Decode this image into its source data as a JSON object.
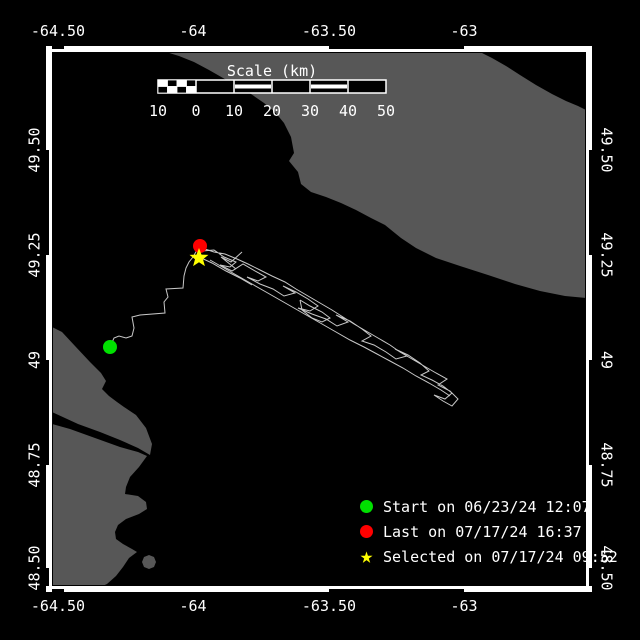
{
  "map": {
    "size": {
      "w": 640,
      "h": 640
    },
    "colors": {
      "water": "#000000",
      "land": "#575757",
      "track": "#c8c8c8",
      "frame": "#ffffff",
      "text": "#ffffff",
      "start": "#00e000",
      "last": "#ff0000",
      "selected": "#ffff00"
    },
    "frame": {
      "inner": {
        "x": 52,
        "y": 52,
        "w": 534,
        "h": 534
      },
      "band_width": 6,
      "black_segments_h": [
        [
          52,
          64
        ],
        [
          329,
          464
        ]
      ],
      "black_segments_v": [
        [
          150,
          255
        ],
        [
          360,
          465
        ],
        [
          568,
          586
        ]
      ]
    },
    "axes": {
      "lon_labels": [
        {
          "label": "-64.50",
          "x": 58
        },
        {
          "label": "-64",
          "x": 193
        },
        {
          "label": "-63.50",
          "x": 329
        },
        {
          "label": "-63",
          "x": 464
        }
      ],
      "lat_labels": [
        {
          "label": "49.50",
          "y": 150
        },
        {
          "label": "49.25",
          "y": 255
        },
        {
          "label": "49",
          "y": 360
        },
        {
          "label": "48.75",
          "y": 465
        },
        {
          "label": "48.50",
          "y": 568
        }
      ],
      "top_baseline_y": 36,
      "bottom_baseline_y": 611,
      "left_center_x": 35,
      "right_center_x": 606
    },
    "scalebar": {
      "title": "Scale (km)",
      "title_x": 272,
      "title_y": 75,
      "bar": {
        "x": 158,
        "y": 80,
        "w": 228,
        "h": 13
      },
      "tick_xs": [
        158,
        196,
        234,
        272,
        310,
        348,
        386
      ],
      "tick_labels": [
        "10",
        "0",
        "10",
        "20",
        "30",
        "40",
        "50"
      ],
      "labels_baseline_y": 116,
      "striped_sections": [
        [
          234,
          272
        ],
        [
          310,
          348
        ]
      ],
      "checker_section": [
        158,
        196
      ]
    },
    "legend": {
      "items": [
        {
          "marker": "circle",
          "color": "#00e000",
          "label": "Start on 06/23/24 12:07"
        },
        {
          "marker": "circle",
          "color": "#ff0000",
          "label": "Last on 07/17/24 16:37"
        },
        {
          "marker": "star",
          "color": "#ffff00",
          "glyph": "★",
          "label": "Selected on 07/17/24 09:52"
        }
      ]
    },
    "land": [
      {
        "name": "land-north-anticosti",
        "points": "155,52 480,52 492,58 506,66 520,75 536,85 552,94 566,101 578,106 586,110 586,298 565,296 540,291 515,284 488,275 460,266 436,258 416,248 401,238 385,225 371,218 356,210 341,203 326,197 311,192 301,184 298,172 289,161 294,153 291,137 284,123 275,112 264,103 251,94 237,86 223,78 209,70 194,62 179,56 166,52"
      },
      {
        "name": "land-gaspe-north",
        "points": "52,327 62,332 75,346 90,362 101,373 106,381 102,389 109,396 117,402 124,407 136,415 146,428 152,444 150,455 138,448 120,440 100,432 78,424 52,412"
      },
      {
        "name": "land-gaspe-south",
        "points": "52,424 70,429 95,438 120,447 138,452 147,456 139,467 130,477 126,487 125,494 138,496 146,502 147,509 139,514 126,519 118,525 115,532 116,539 123,544 132,549 137,552 129,558 123,567 116,576 107,584 98,588 52,588"
      },
      {
        "name": "small-island",
        "points": "149,555 154,557 156,562 154,567 149,569 144,567 142,562 144,557"
      }
    ],
    "track": [
      "110,347 114,338 119,336 126,338 132,336 134,328 132,317 140,315 165,313 164,302 168,297 166,289 183,288 184,276 186,268 189,262 193,257 197,250 200,247",
      "202,251 214,250 224,257 236,262 230,267 220,265 232,271 243,264 255,271 266,277 258,281 247,277 260,284 273,289 284,296 295,293 283,286 296,292 308,299 318,306 310,311 298,308 312,314 326,319 337,326 348,322 336,315 350,321 362,329 371,336 362,341 374,345 386,352 396,359 407,356 395,349 408,355 420,363 429,371 421,375 432,380 443,386 452,393 445,399 434,395 443,401 452,406 458,399 450,391 438,385 447,379 436,373 424,366 412,359 400,352 390,345 378,338 366,331 354,324 343,317 332,310 320,303 308,296 296,289 285,282 272,276 260,270 248,264 237,259 225,254 214,252 205,249",
      "210,260 224,268 238,276 252,284 266,292 280,300 294,308 308,316 322,324 336,332 350,340 364,347 377,354 390,361 403,368 416,376 429,383 441,390 450,396",
      "300,300 310,306 322,312 330,318 322,322 312,318 302,310 300,300",
      "199,257 212,263 226,271 240,278 252,285",
      "242,252 231,262 221,257 236,269"
    ],
    "markers": [
      {
        "name": "start-marker",
        "type": "circle",
        "x": 110,
        "y": 347,
        "r": 7,
        "color": "#00e000"
      },
      {
        "name": "last-marker",
        "type": "circle",
        "x": 200,
        "y": 246,
        "r": 7,
        "color": "#ff0000"
      },
      {
        "name": "selected-marker",
        "type": "star",
        "x": 199,
        "y": 258,
        "ro": 10,
        "ri": 4.2,
        "color": "#ffff00"
      }
    ]
  }
}
